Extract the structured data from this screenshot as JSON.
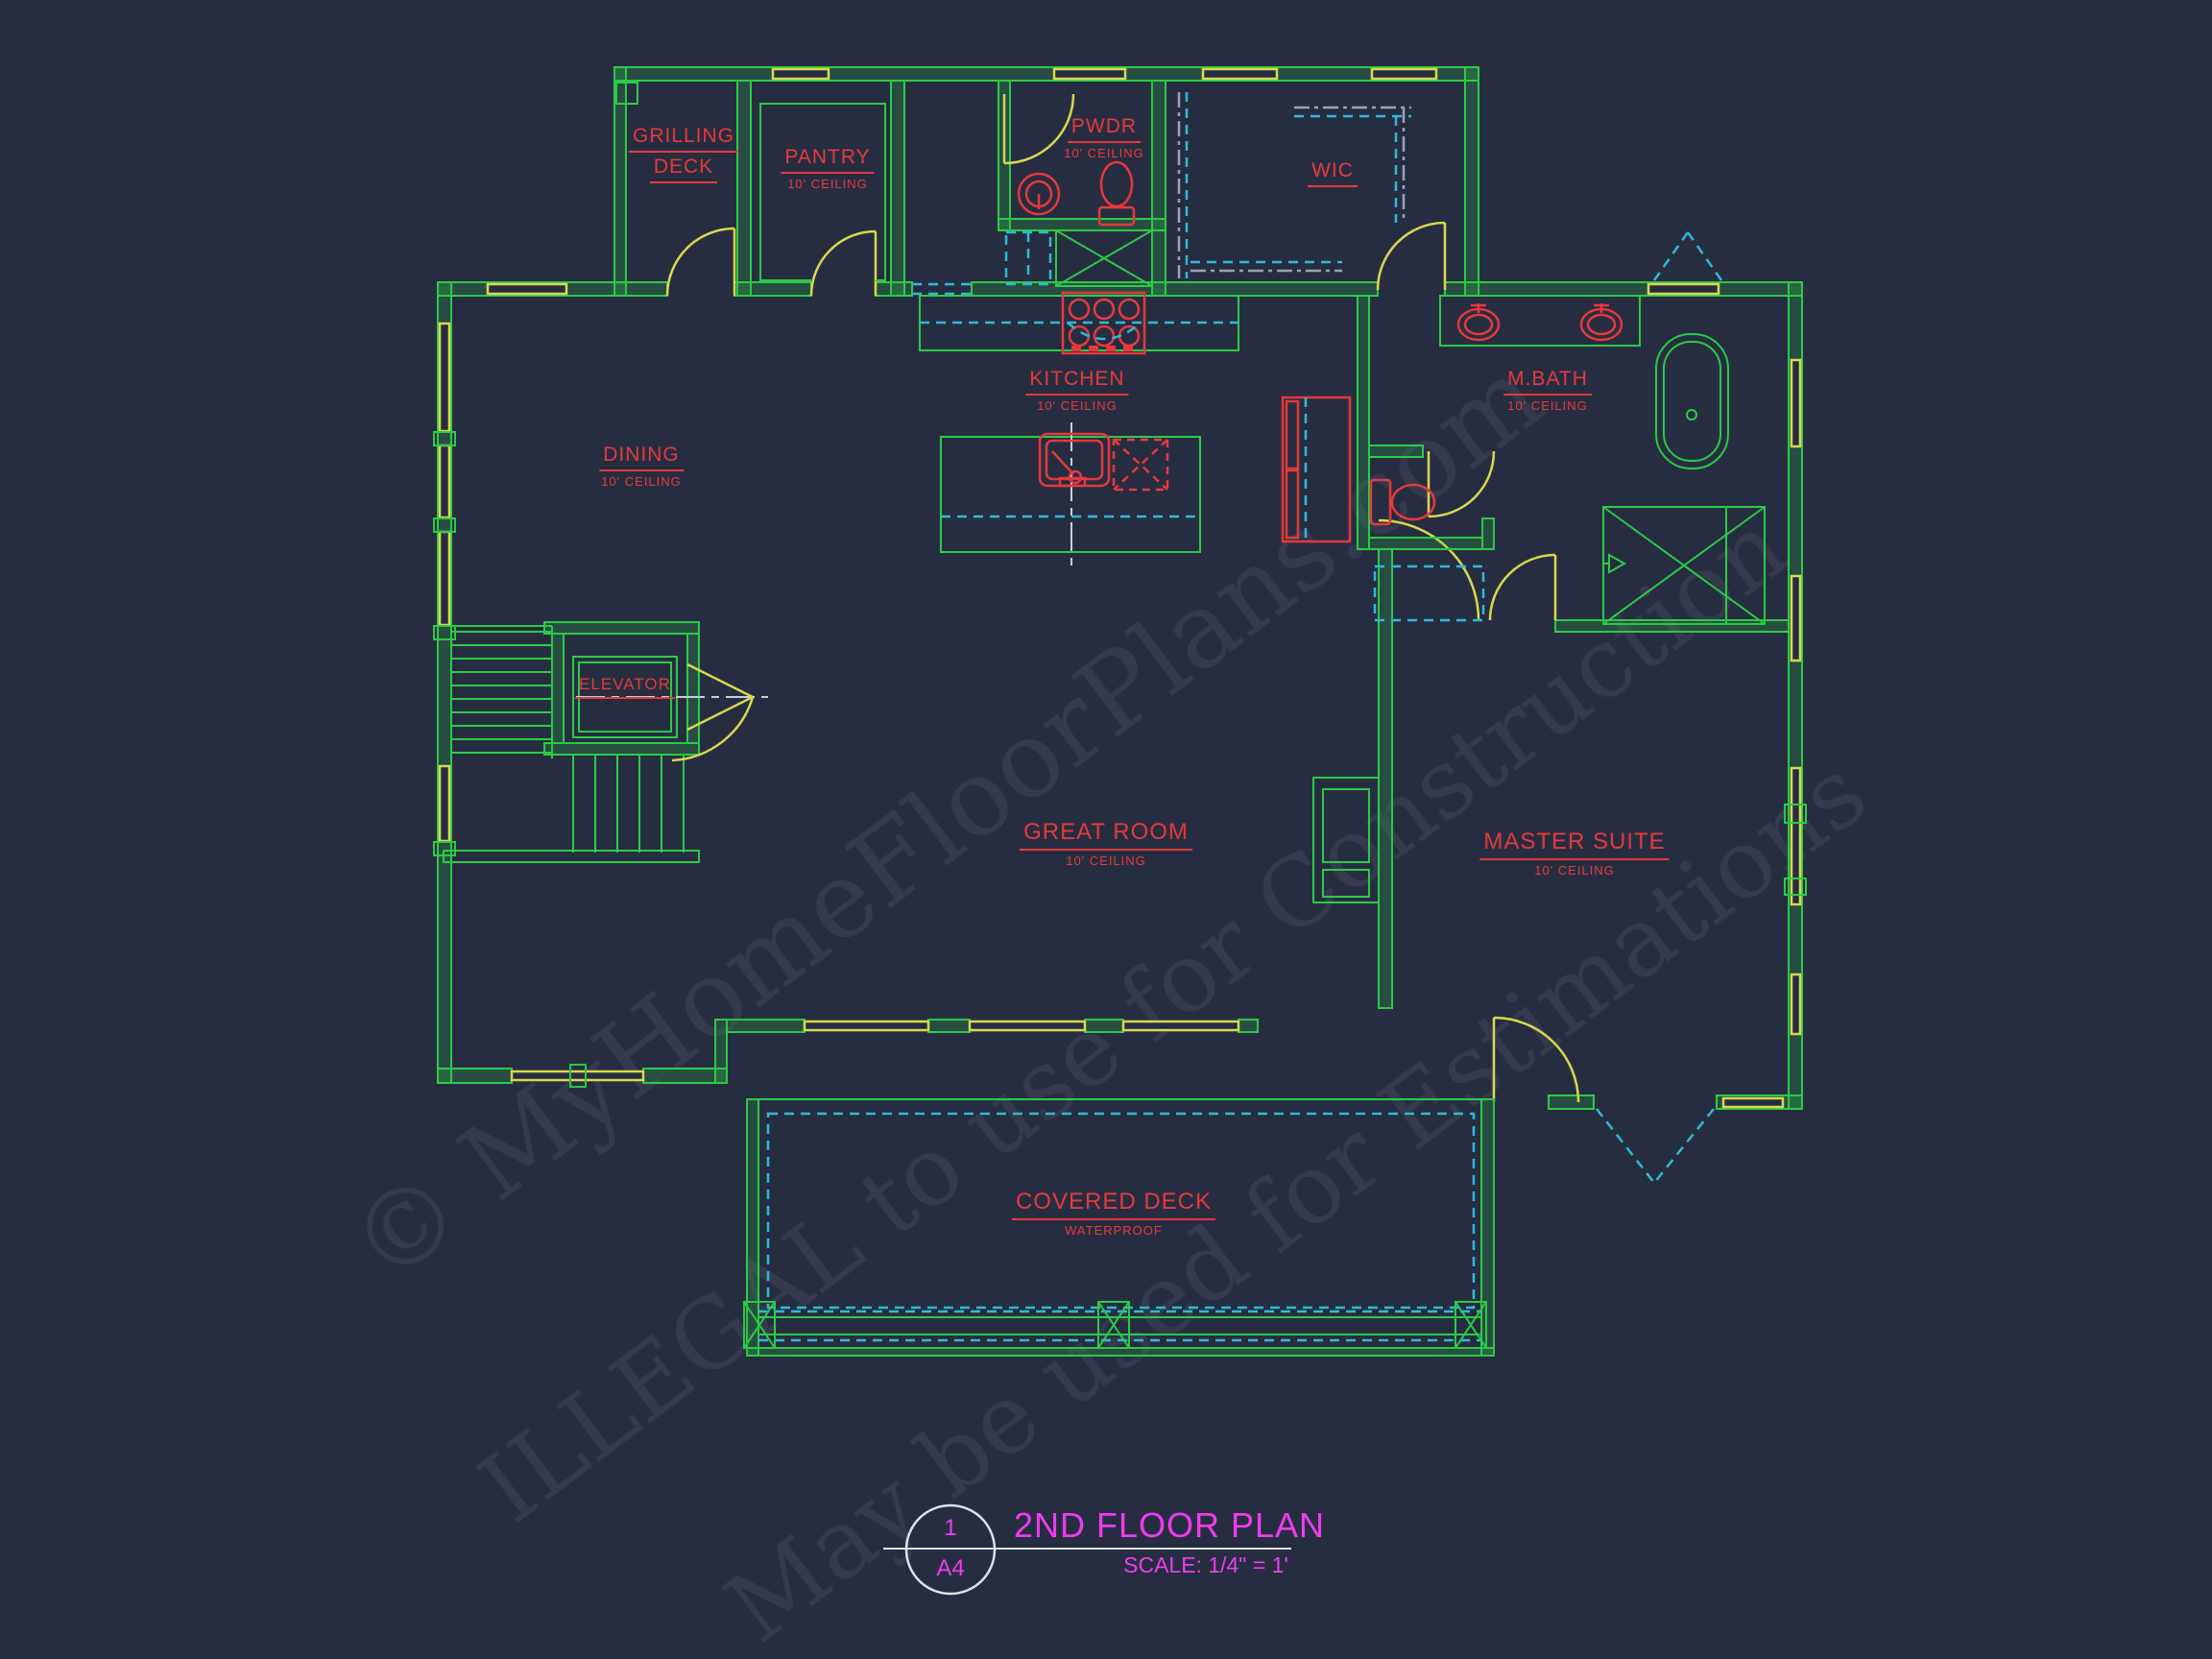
{
  "colors": {
    "background": "#272D41",
    "walls_green": "#2BCB45",
    "doors_windows_yellow": "#D9D84F",
    "labels_red": "#E5393C",
    "dashed_cyan": "#31B8D8",
    "centerline_white": "#DDE3EE",
    "shelving_gray": "#9AA4B5",
    "title_magenta": "#EE3CEE"
  },
  "rooms": {
    "grilling_deck": {
      "line1": "GRILLING",
      "line2": "DECK"
    },
    "pantry": {
      "label": "PANTRY",
      "sub": "10' CEILING"
    },
    "pwdr": {
      "label": "PWDR",
      "sub": "10' CEILING"
    },
    "wic": {
      "label": "WIC"
    },
    "kitchen": {
      "label": "KITCHEN",
      "sub": "10' CEILING"
    },
    "mbath": {
      "label": "M.BATH",
      "sub": "10' CEILING"
    },
    "dining": {
      "label": "DINING",
      "sub": "10' CEILING"
    },
    "elevator": {
      "label": "ELEVATOR"
    },
    "great_room": {
      "label": "GREAT ROOM",
      "sub": "10' CEILING"
    },
    "master_suite": {
      "label": "MASTER SUITE",
      "sub": "10' CEILING"
    },
    "covered_deck": {
      "label": "COVERED DECK",
      "sub": "WATERPROOF"
    }
  },
  "title_block": {
    "detail_number": "1",
    "sheet": "A4",
    "title": "2ND FLOOR PLAN",
    "scale": "SCALE:  1/4\" = 1'"
  },
  "watermarks": {
    "line1": "© MyHomeFloorPlans.com",
    "line2": "ILLEGAL to use for Construction",
    "line3": "May be used for Estimations"
  }
}
